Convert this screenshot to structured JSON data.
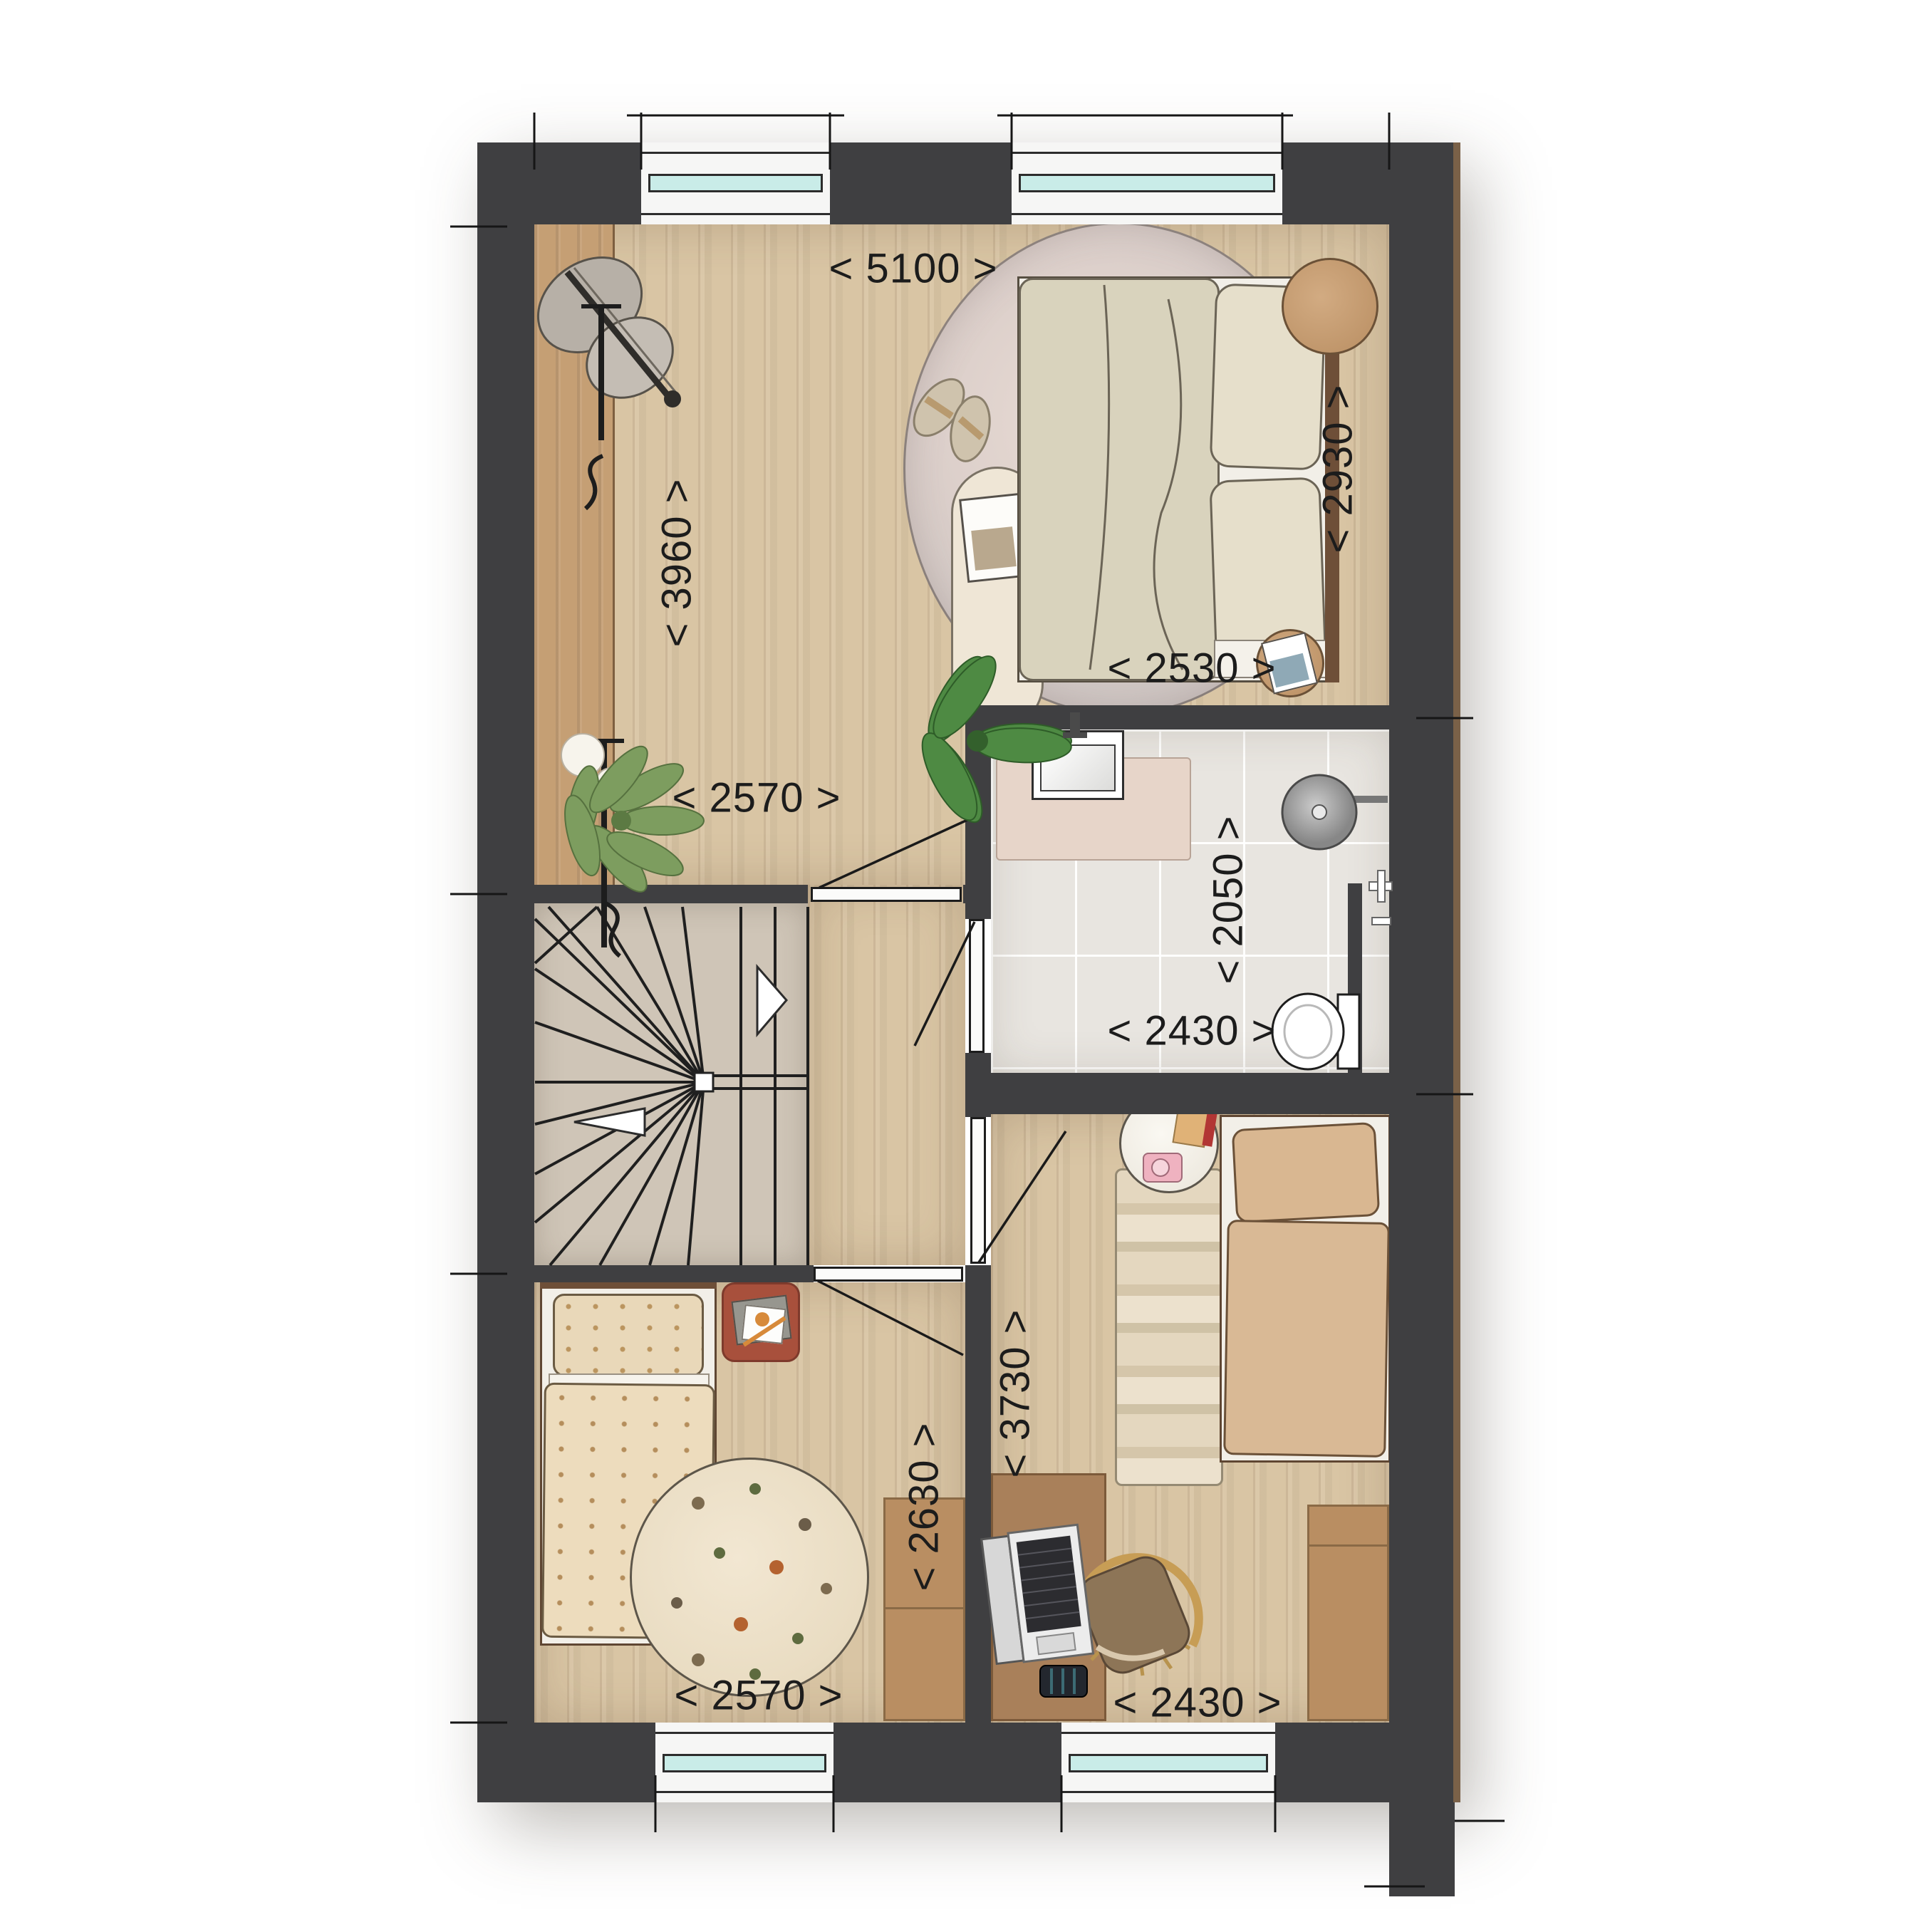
{
  "dims": {
    "bedroom1_width": "< 5100 >",
    "bedroom1_depth": "< 3960 >",
    "bed_zone_depth": "< 2930 >",
    "bed_zone_width": "< 2530 >",
    "bedroom1_inner_width": "< 2570 >",
    "bathroom_depth": "< 2050 >",
    "bathroom_width": "< 2430 >",
    "bedroom2_depth": "< 2630 >",
    "bedroom2_width": "< 2570 >",
    "bedroom3_depth": "< 3730 >",
    "bedroom3_width": "< 2430 >"
  },
  "colors": {
    "wall": "#3f3f41",
    "wood_floor": "#d9c5a4",
    "wood_dark": "#c59f74",
    "tile": "#e8e5e0",
    "stairs": "#cfc5b7",
    "window_glass": "#c9ece8",
    "rug_accent": "#a8503c",
    "dim_text": "#1c1c1c"
  }
}
